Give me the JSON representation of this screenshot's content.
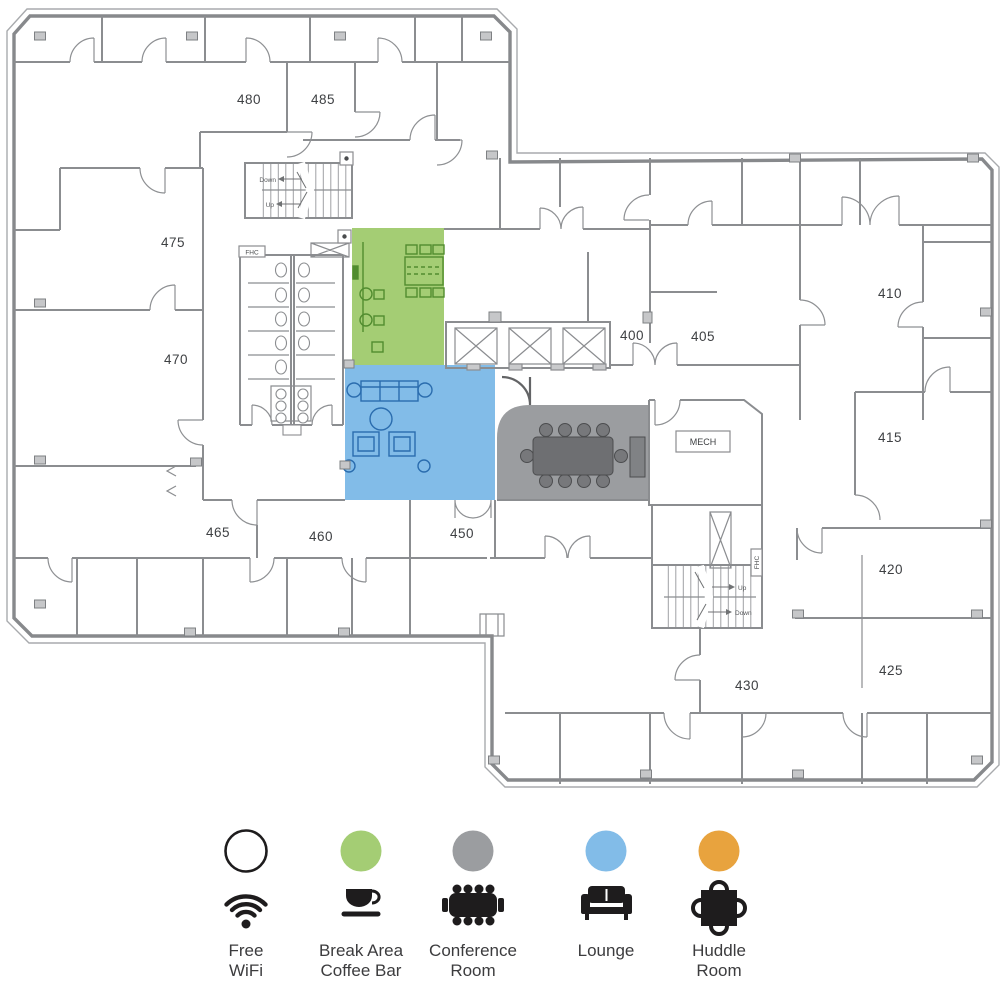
{
  "floorplan": {
    "rooms": [
      {
        "label": "480"
      },
      {
        "label": "485"
      },
      {
        "label": "475"
      },
      {
        "label": "470"
      },
      {
        "label": "465"
      },
      {
        "label": "460"
      },
      {
        "label": "450"
      },
      {
        "label": "400"
      },
      {
        "label": "405"
      },
      {
        "label": "410"
      },
      {
        "label": "415"
      },
      {
        "label": "420"
      },
      {
        "label": "425"
      },
      {
        "label": "430"
      }
    ],
    "utility": {
      "mech": "MECH",
      "fhc_top": "FHC",
      "fhc_bottom": "FHC",
      "down_top": "Down",
      "up_top": "Up",
      "up_bottom": "Up",
      "down_bottom": "Down"
    },
    "colors": {
      "break_area": "#a4cd74",
      "lounge": "#82bce8",
      "conference": "#9b9da0",
      "huddle": "#e8a33e",
      "walls": "#8b8d90"
    }
  },
  "legend": {
    "items": [
      {
        "id": "free-wifi",
        "circle_color": "#ffffff",
        "icon": "wifi-icon",
        "line1": "Free",
        "line2": "WiFi"
      },
      {
        "id": "break-area-coffee-bar",
        "circle_color": "#a4cd74",
        "icon": "coffee-cup-icon",
        "line1": "Break Area",
        "line2": "Coffee Bar"
      },
      {
        "id": "conference-room",
        "circle_color": "#9b9da0",
        "icon": "conference-table-icon",
        "line1": "Conference",
        "line2": "Room"
      },
      {
        "id": "lounge",
        "circle_color": "#82bce8",
        "icon": "sofa-icon",
        "line1": "Lounge",
        "line2": ""
      },
      {
        "id": "huddle-room",
        "circle_color": "#e8a33e",
        "icon": "huddle-table-icon",
        "line1": "Huddle",
        "line2": "Room"
      }
    ]
  }
}
